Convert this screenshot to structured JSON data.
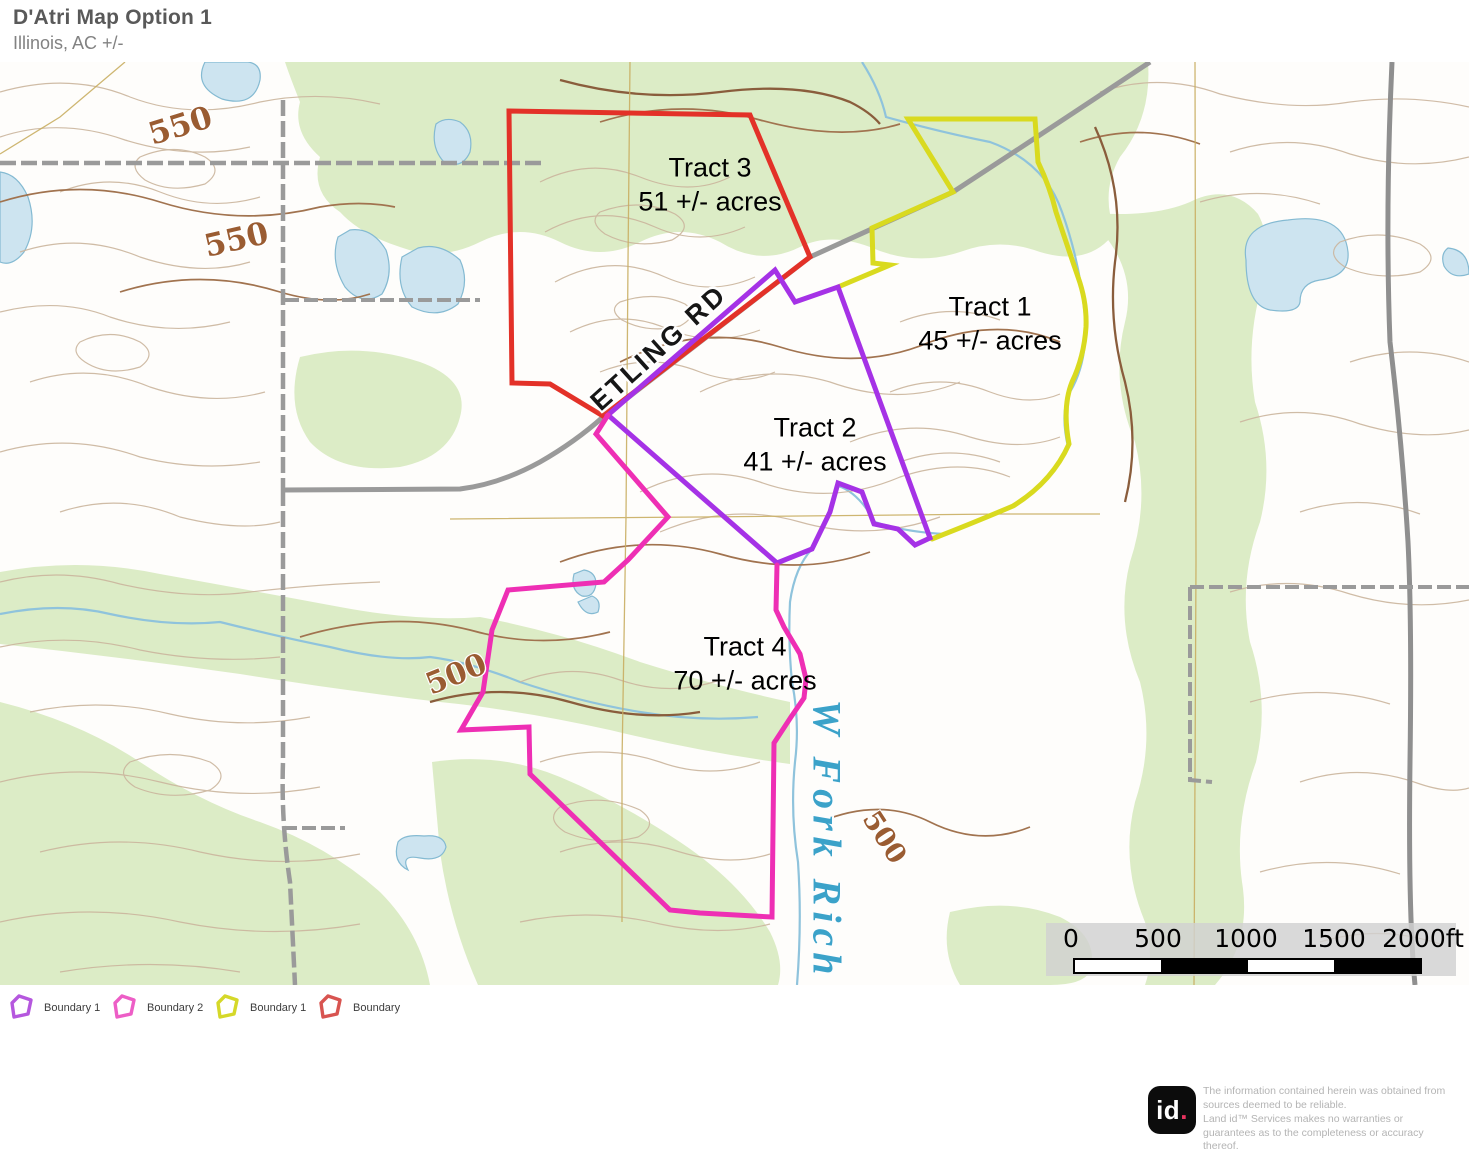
{
  "header": {
    "title": "D'Atri Map Option 1",
    "subtitle": "Illinois,  AC +/-"
  },
  "tracts": {
    "t1": {
      "name": "Tract 1",
      "acres": "45 +/- acres"
    },
    "t2": {
      "name": "Tract 2",
      "acres": "41 +/- acres"
    },
    "t3": {
      "name": "Tract 3",
      "acres": "51 +/- acres"
    },
    "t4": {
      "name": "Tract 4",
      "acres": "70 +/- acres"
    }
  },
  "map_labels": {
    "road": "ETLING RD",
    "stream": "W Fork Rich",
    "contour_550a": "550",
    "contour_550b": "550",
    "contour_500a": "500",
    "contour_500b": "500"
  },
  "scale_bar": {
    "t0": "0",
    "t1": "500",
    "t2": "1000",
    "t3": "1500",
    "t4": "2000ft"
  },
  "legend": {
    "items": [
      {
        "label": "Boundary 1",
        "color": "#b557de"
      },
      {
        "label": "Boundary 2",
        "color": "#ed5ec6"
      },
      {
        "label": "Boundary 1",
        "color": "#d5d829"
      },
      {
        "label": "Boundary",
        "color": "#d85450"
      }
    ]
  },
  "colors": {
    "boundary_red": "#e33128",
    "boundary_yellow": "#d9da1f",
    "boundary_purple": "#a532e6",
    "boundary_pink": "#ee2fb4"
  },
  "footer": {
    "logo_id": "id",
    "logo_dot": ".",
    "disclaimer": "The information contained herein was obtained from sources deemed to be reliable.\n Land id™ Services makes no warranties or guarantees as to the completeness or accuracy thereof."
  }
}
